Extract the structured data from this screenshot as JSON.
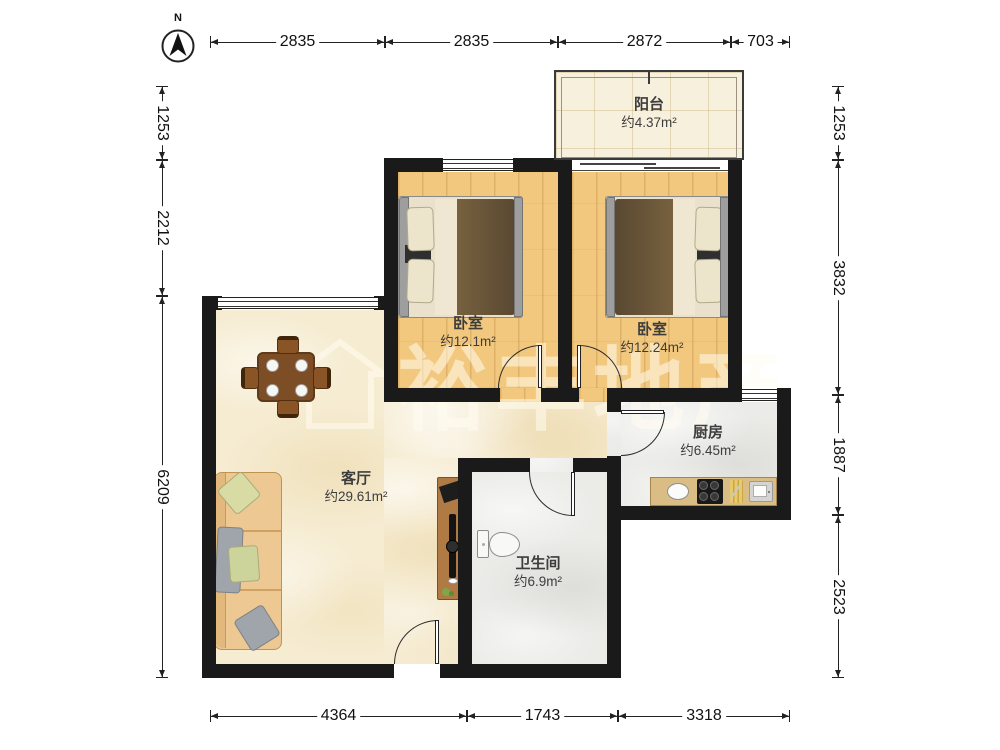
{
  "compass": {
    "north_label": "N"
  },
  "watermark": {
    "text": "裕丰地产"
  },
  "rooms": {
    "balcony": {
      "name": "阳台",
      "area": "约4.37m²"
    },
    "bedroom_left": {
      "name": "卧室",
      "area": "约12.1m²"
    },
    "bedroom_right": {
      "name": "卧室",
      "area": "约12.24m²"
    },
    "kitchen": {
      "name": "厨房",
      "area": "约6.45m²"
    },
    "living_room": {
      "name": "客厅",
      "area": "约29.61m²"
    },
    "bathroom": {
      "name": "卫生间",
      "area": "约6.9m²"
    }
  },
  "dimensions": {
    "top": [
      "2835",
      "2835",
      "2872",
      "703"
    ],
    "bottom": [
      "4364",
      "1743",
      "3318"
    ],
    "left": [
      "1253",
      "2212",
      "6209"
    ],
    "right": [
      "1253",
      "3832",
      "1887",
      "2523"
    ]
  }
}
